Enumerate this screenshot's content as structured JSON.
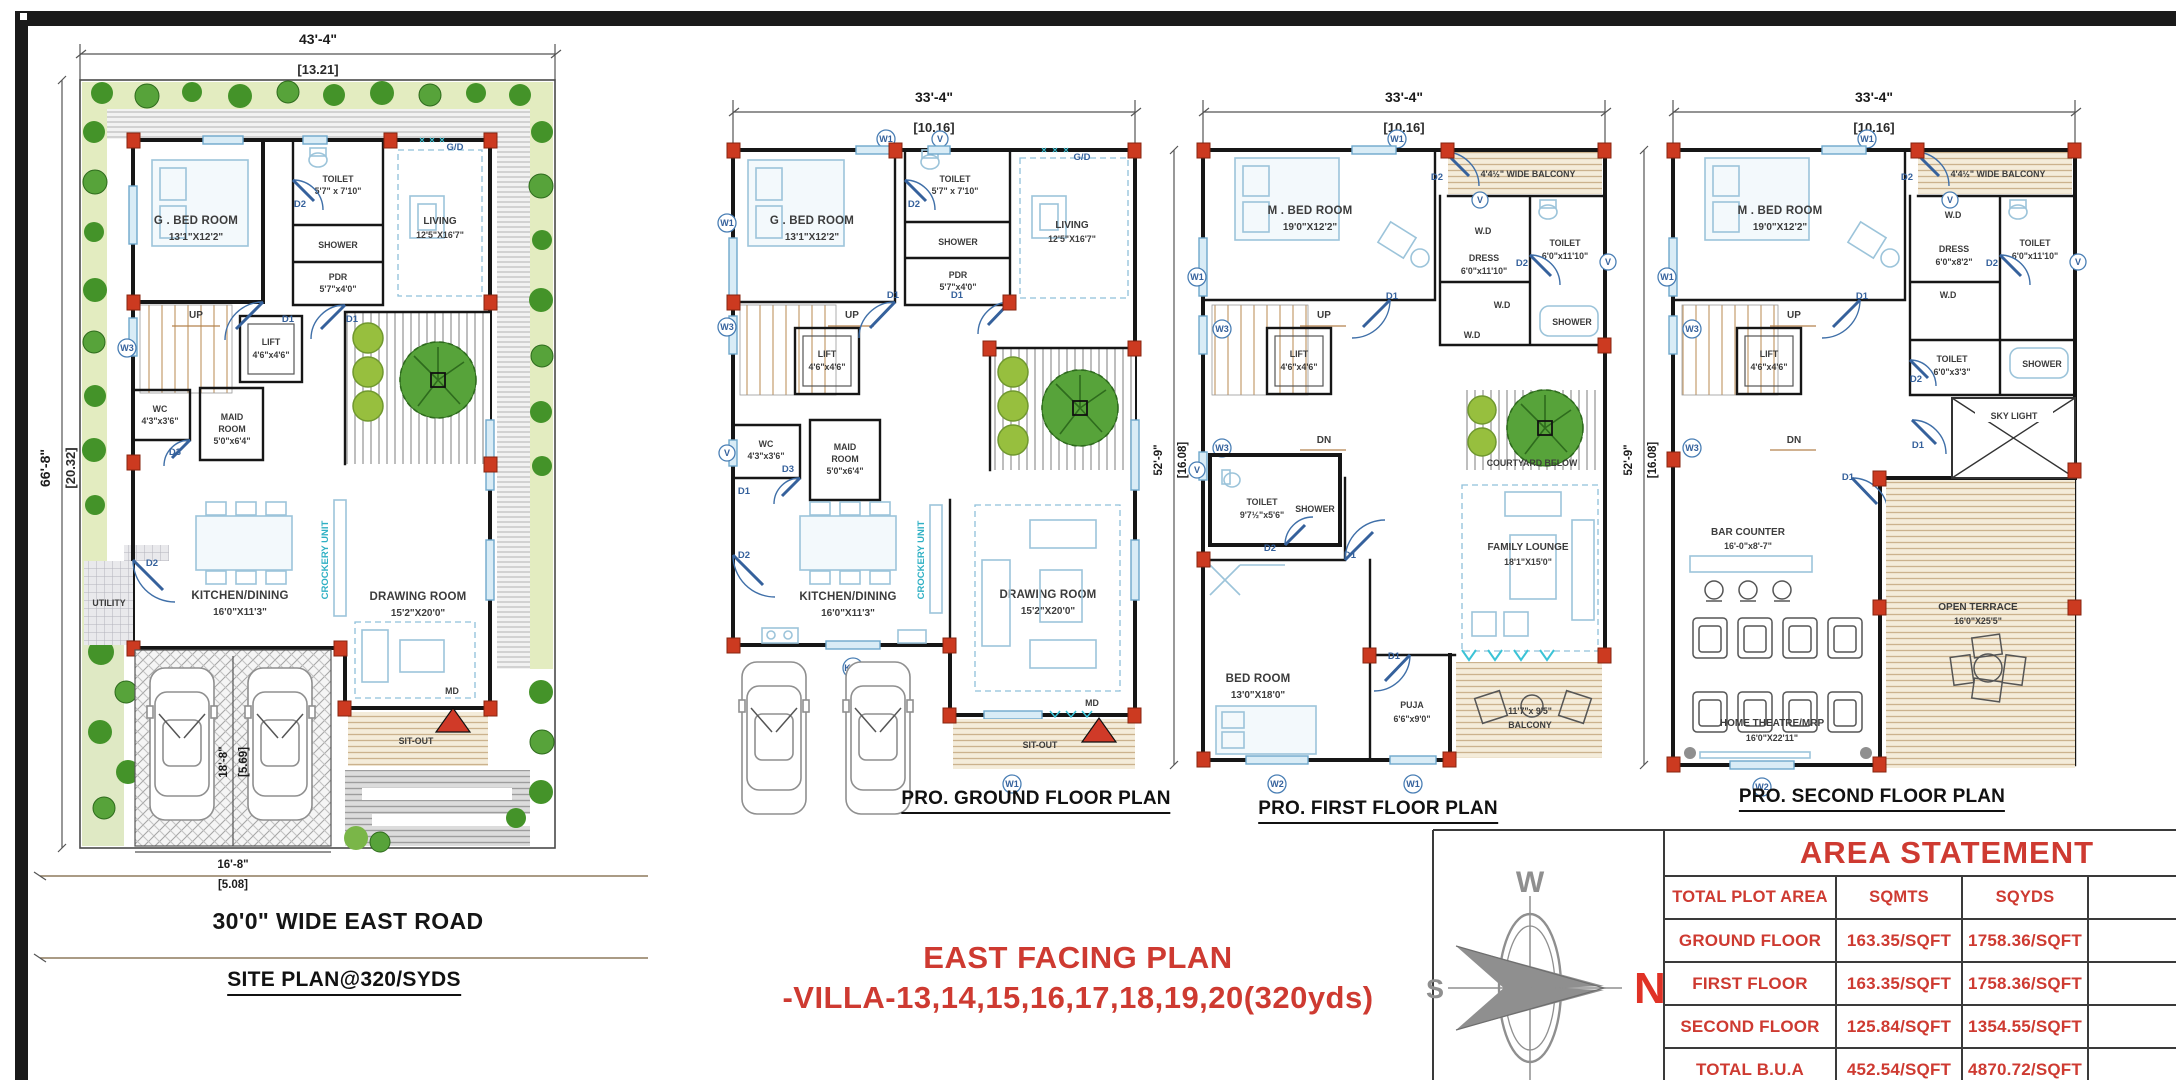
{
  "sheet": {
    "main_title_line1": "EAST FACING PLAN",
    "main_title_line2": "-VILLA-13,14,15,16,17,18,19,20(320yds)",
    "road_label": "30'0\" WIDE EAST ROAD",
    "site_plan_title": "SITE PLAN@320/SYDS",
    "ground_title": "PRO. GROUND FLOOR PLAN",
    "first_title": "PRO. FIRST FLOOR PLAN",
    "second_title": "PRO. SECOND FLOOR PLAN"
  },
  "dims": {
    "w43": "43'-4\"",
    "w43m": "[13.21]",
    "h66": "66'-8\"",
    "h66m": "[20.32]",
    "w33": "33'-4\"",
    "w33m": "[10.16]",
    "h52": "52'-9\"",
    "h52m": "[16.08]",
    "pw": "16'-8\"",
    "pwm": "[5.08]",
    "ph": "18'-8\"",
    "phm": "[5.69]"
  },
  "tags": {
    "w1": "W1",
    "w2": "W2",
    "w3": "W3",
    "v": "V",
    "d1": "D1",
    "d2": "D2",
    "d3": "D3",
    "kw": "K/W",
    "gd": "G/D",
    "up": "UP",
    "dn": "DN",
    "md": "MD",
    "wd": "W.D"
  },
  "rooms": {
    "gbed": {
      "name": "G . BED ROOM",
      "size": "13'1\"X12'2\""
    },
    "toilet_g": {
      "name": "TOILET",
      "size": "5'7\" x 7'10\""
    },
    "shower": {
      "name": "SHOWER"
    },
    "pdr": {
      "name": "PDR",
      "size": "5'7\"x4'0\""
    },
    "living": {
      "name": "LIVING",
      "size": "12'5\"X16'7\""
    },
    "lift": {
      "name": "LIFT",
      "size": "4'6\"x4'6\""
    },
    "wc": {
      "name": "WC",
      "size": "4'3\"x3'6\""
    },
    "maid": {
      "name": "MAID",
      "name2": "ROOM",
      "size": "5'0\"x6'4\""
    },
    "utility": {
      "name": "UTILITY"
    },
    "kitchen": {
      "name": "KITCHEN/DINING",
      "size": "16'0\"X11'3\""
    },
    "crockery": {
      "name": "CROCKERY UNIT"
    },
    "drawing": {
      "name": "DRAWING ROOM",
      "size": "15'2\"X20'0\""
    },
    "sitout": {
      "name": "SIT-OUT"
    },
    "mbed": {
      "name": "M . BED ROOM",
      "size": "19'0\"X12'2\""
    },
    "balcony_top": {
      "name": "4'4½\" WIDE BALCONY"
    },
    "dress1": {
      "name": "DRESS",
      "size": "6'0\"x11'10\""
    },
    "dress2": {
      "name": "DRESS",
      "size": "6'0\"x8'2\""
    },
    "toilet_big": {
      "name": "TOILET",
      "size": "6'0\"x11'10\""
    },
    "toilet_f": {
      "name": "TOILET",
      "size": "9'7½\"x5'6\""
    },
    "toilet_s": {
      "name": "TOILET",
      "size": "6'0\"x3'3\""
    },
    "courtyard": {
      "name": "COURTYARD BELOW"
    },
    "family": {
      "name": "FAMILY LOUNGE",
      "size": "18'1\"X15'0\""
    },
    "bed1": {
      "name": "BED ROOM",
      "size": "13'0\"X18'0\""
    },
    "puja": {
      "name": "PUJA",
      "size": "6'6\"x9'0\""
    },
    "balcony1": {
      "size": "11'7\"x 9'5\"",
      "name": "BALCONY"
    },
    "skylight": {
      "name": "SKY LIGHT"
    },
    "bar": {
      "name": "BAR COUNTER",
      "size": "16'-0\"x8'-7\""
    },
    "terrace": {
      "name": "OPEN TERRACE",
      "size": "16'0\"X25'5\""
    },
    "theatre": {
      "name": "HOME THEATRE/MRP",
      "size": "16'0\"X22'11\""
    }
  },
  "compass": {
    "n": "N",
    "s": "S",
    "w": "W",
    "e": "E"
  },
  "area_table": {
    "title": "AREA STATEMENT",
    "headers": [
      "TOTAL PLOT AREA",
      "SQMTS",
      "SQYDS"
    ],
    "rows": [
      {
        "label": "GROUND FLOOR",
        "sqmts": "163.35/SQFT",
        "sqyds": "1758.36/SQFT"
      },
      {
        "label": "FIRST FLOOR",
        "sqmts": "163.35/SQFT",
        "sqyds": "1758.36/SQFT"
      },
      {
        "label": "SECOND FLOOR",
        "sqmts": "125.84/SQFT",
        "sqyds": "1354.55/SQFT"
      },
      {
        "label": "TOTAL B.U.A",
        "sqmts": "452.54/SQFT",
        "sqyds": "4870.72/SQFT"
      }
    ]
  },
  "colors": {
    "accent_red": "#ce3a31",
    "column_red": "#cc3a20",
    "wall_black": "#161616",
    "furniture_blue": "#9cc4da",
    "tree_green": "#449329"
  }
}
